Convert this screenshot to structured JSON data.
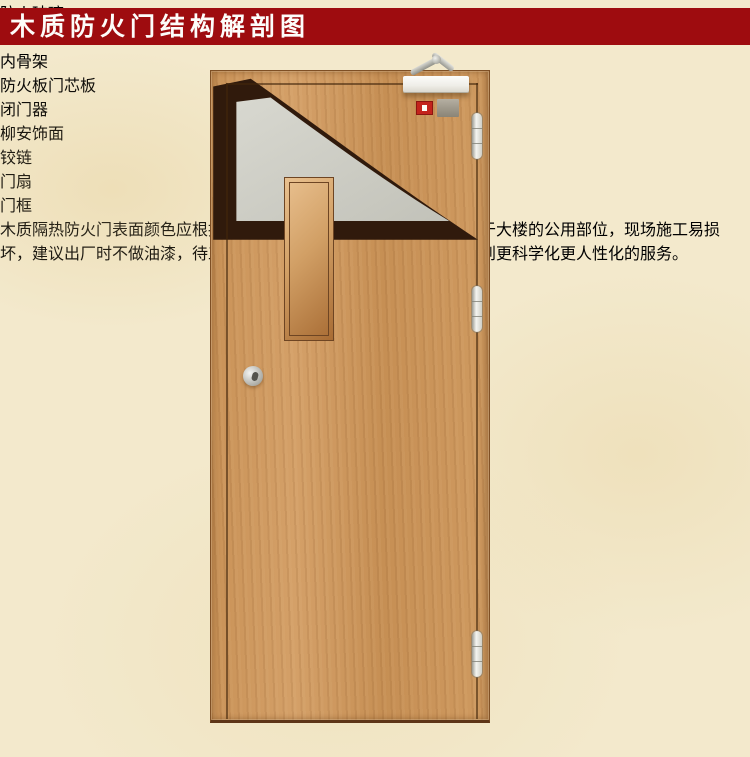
{
  "title": {
    "text": "木质防火门结构解剖图"
  },
  "colors": {
    "title_bar": "#9e0c0f",
    "background": "#f3e9cc",
    "leader_line": "#d13a1e",
    "door_wood": "#cc9760",
    "cutaway_skeleton": "#301a0c",
    "cutaway_core": "#cfcfc6",
    "alarm_red": "#c3231c"
  },
  "labels_left": [
    {
      "id": "fire-glass",
      "text": "防火玻璃"
    },
    {
      "id": "fire-lock",
      "text": "防火锁"
    },
    {
      "id": "inner-skeleton",
      "text": "内骨架"
    },
    {
      "id": "core-board",
      "text": "防火板门芯板"
    }
  ],
  "labels_right": [
    {
      "id": "door-closer",
      "text": "闭门器"
    },
    {
      "id": "veneer",
      "text": "柳安饰面"
    },
    {
      "id": "hinge",
      "text": "铰链"
    },
    {
      "id": "door-leaf",
      "text": "门扇"
    },
    {
      "id": "door-frame",
      "text": "门框"
    }
  ],
  "description": {
    "text": "木质隔热防火门表面颜色应根据用户需要而确定，因为防火门主要用于大楼的公用部位，现场施工易损坏，建议出厂时不做油漆，待工程全面快完工时，在现场做油漆。达到更科学化更人性化的服务。"
  }
}
